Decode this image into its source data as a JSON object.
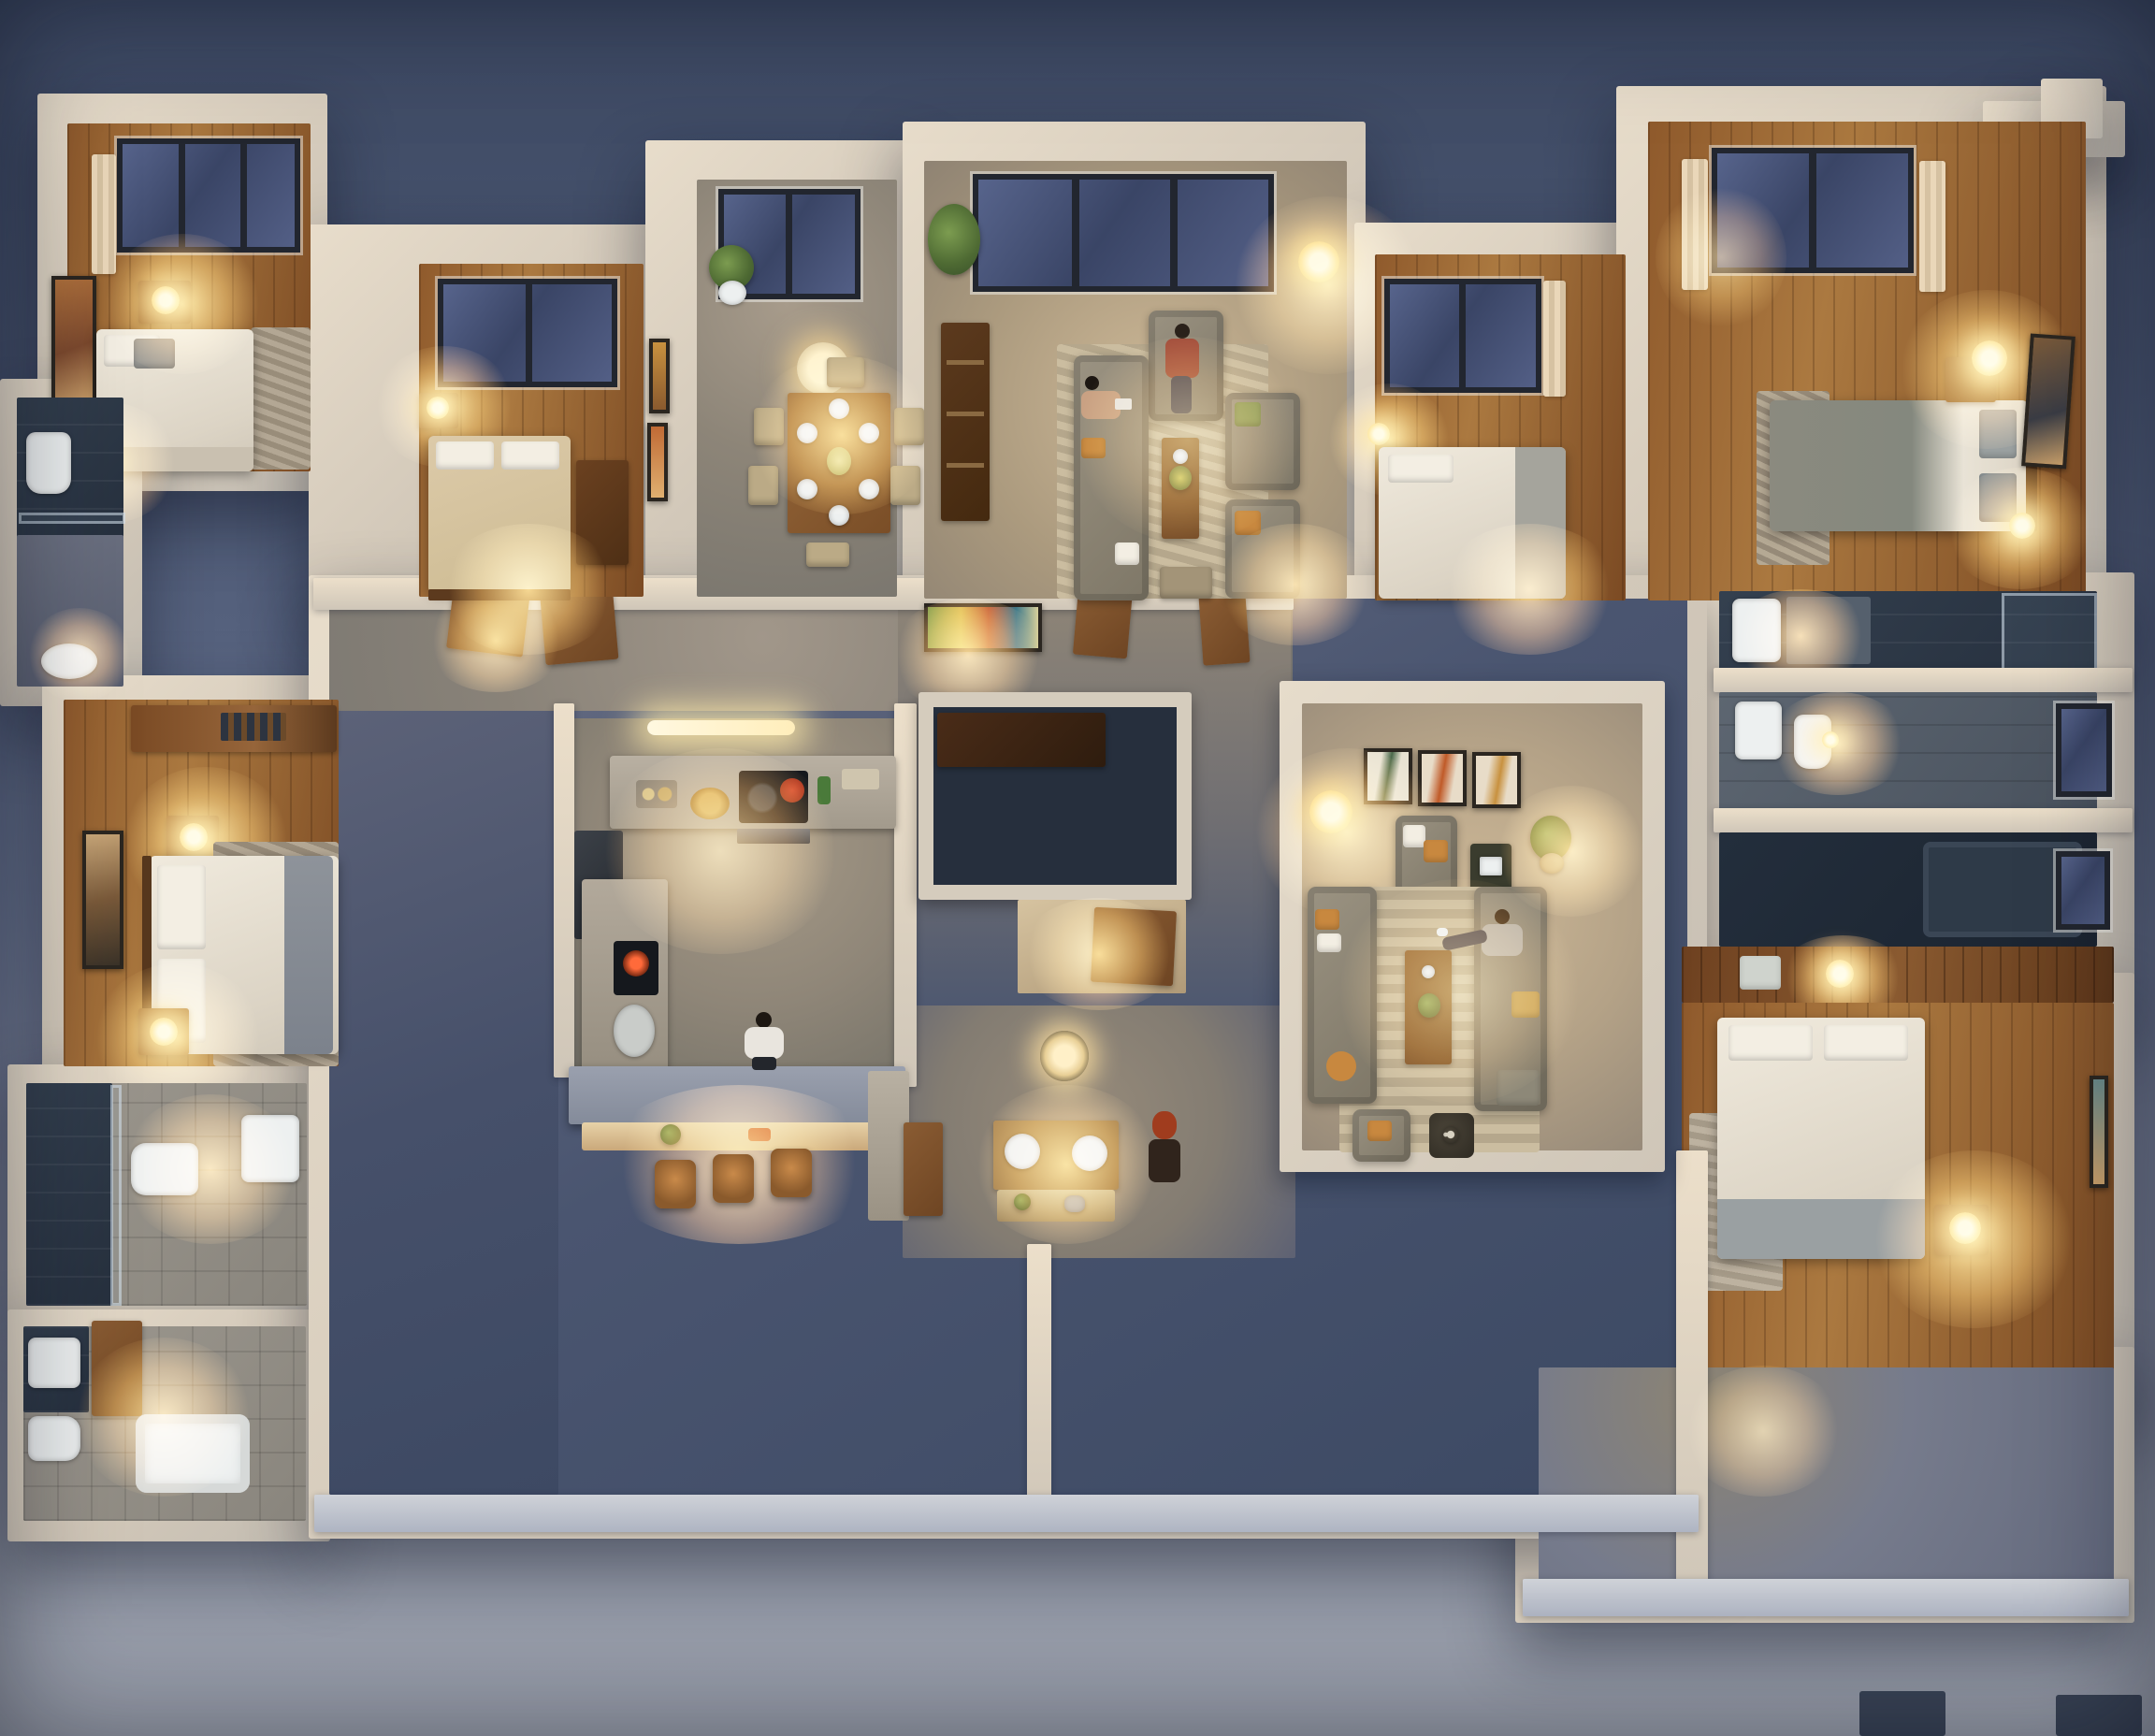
{
  "scene": {
    "type": "architectural-3d-render",
    "view": "top-down dollhouse cutaway floor plan",
    "time_of_day": "dusk",
    "mood": "warm interior lamp light against blue evening exterior"
  },
  "palette": {
    "sky_top": "#3d4963",
    "sky_mid": "#55617d",
    "sky_low": "#7e869d",
    "ground": "#9298a6",
    "ground_low": "#9ea3af",
    "wall_lit": "#d9cfc1",
    "wall_warm": "#ecd9bc",
    "wall_shadow": "#aeb4c2",
    "wood_a": "#8f5a2c",
    "wood_b": "#ab7940",
    "wood_dark": "#56371d",
    "concrete_warm": "#998f81",
    "concrete_cool": "#767b8c",
    "concrete_dark": "#3f4b66",
    "glass": "#3a4566",
    "frame_dark": "#22262f",
    "glow_warm": "#ffd88c",
    "lamp_core": "#fff6d8",
    "sofa_fabric": "#8d8575",
    "cushion_orange": "#c8883f",
    "bed_white": "#eae4d8",
    "bed_gray": "#97999a",
    "duvet_beige": "#d8c8a9",
    "duvet_graygreen": "#8b8a7f",
    "rug_beige": "#c6b89d",
    "rug_gray": "#9d968a",
    "table_wood": "#8a5c33",
    "chair_beige": "#b7a683",
    "plant_green": "#5d7a3d",
    "tile_warm": "#94908a",
    "tile_dark": "#2c3645",
    "fixture_white": "#eceff0",
    "curtain_cream": "#e2d7c2",
    "skin": "#c9a183",
    "hair_dark": "#2a211a",
    "hair_red": "#a03c1e",
    "shirt_white": "#e9e5de",
    "shirt_pattern": "#a04a3a",
    "denim": "#3c4252"
  },
  "rooms": [
    {
      "name": "bedroom-top-left",
      "floor": "wood",
      "furniture": [
        "double bed",
        "nightstand with lit lamp",
        "foot-of-bed lamp",
        "window with curtains",
        "wall art",
        "textured rug"
      ]
    },
    {
      "name": "bedroom-top-left-2",
      "floor": "wood",
      "furniture": [
        "double bed with beige duvet",
        "nightstand with lamp",
        "window",
        "wardrobe"
      ]
    },
    {
      "name": "dining-room",
      "floor": "concrete",
      "furniture": [
        "wood dining table set for six",
        "six beige chairs",
        "drum pendant lamp",
        "potted plant",
        "picture window",
        "two wall artworks"
      ]
    },
    {
      "name": "living-room-north",
      "floor": "carpet",
      "furniture": [
        "long sofa",
        "accent armchair",
        "two armchairs",
        "coffee table with flowers",
        "bookshelf",
        "tripod floor lamp",
        "potted palm",
        "wide window",
        "stool"
      ]
    },
    {
      "name": "bedroom-north-right",
      "floor": "wood",
      "furniture": [
        "white double bed",
        "small lit lamp",
        "window with curtain"
      ]
    },
    {
      "name": "bedroom-top-right",
      "floor": "wood",
      "furniture": [
        "double bed with gray-green duvet",
        "nightstand with glowing sphere lamp",
        "second lamp",
        "wide window with curtains",
        "wall art",
        "textured rug"
      ]
    },
    {
      "name": "bathroom-left-top",
      "floor": "dark tile",
      "furniture": [
        "walk-in shower",
        "toilet",
        "oval sink"
      ]
    },
    {
      "name": "bedroom-left-middle",
      "floor": "wood",
      "furniture": [
        "double bed with gray throw",
        "two nightstands with lit lamps",
        "wardrobe shelf",
        "large wall art",
        "textured rug"
      ]
    },
    {
      "name": "bathroom-left-middle",
      "floor": "tile",
      "furniture": [
        "glass shower",
        "toilet",
        "vanity sink"
      ]
    },
    {
      "name": "bathroom-left-bottom",
      "floor": "tile",
      "furniture": [
        "bathtub",
        "vanity sink",
        "toilet",
        "dark shower",
        "wood bath mat"
      ]
    },
    {
      "name": "kitchen",
      "floor": "concrete",
      "furniture": [
        "L-shaped counter",
        "cooktop with red pot",
        "oven",
        "island cooktop",
        "steel sink",
        "breakfast bar with lit ledge",
        "three bar stools",
        "ceiling tube light"
      ]
    },
    {
      "name": "hallway",
      "floor": "concrete",
      "furniture": [
        "open wood doors",
        "colorful wall painting"
      ]
    },
    {
      "name": "closet-room",
      "floor": "dark",
      "furniture": [
        "wood cabinet"
      ]
    },
    {
      "name": "vanity-bathroom-center",
      "floor": "concrete",
      "furniture": [
        "double round-basin wood vanity",
        "toiletry shelf",
        "ring ceiling light",
        "side cabinet"
      ]
    },
    {
      "name": "living-room-south",
      "floor": "carpet",
      "furniture": [
        "two facing sofas",
        "accent armchair",
        "dark pouf",
        "coffee table with plant",
        "triptych wall art",
        "tripod floor lamp",
        "potted plant",
        "striped rug",
        "side table"
      ]
    },
    {
      "name": "bathroom-right-1",
      "floor": "dark tile",
      "furniture": [
        "lit vanity basin",
        "glass shower"
      ]
    },
    {
      "name": "bathroom-right-2",
      "floor": "tile",
      "furniture": [
        "sink",
        "toilet",
        "window",
        "ceiling bulb"
      ]
    },
    {
      "name": "bathroom-right-3",
      "floor": "dark tile",
      "furniture": [
        "bathtub",
        "window"
      ]
    },
    {
      "name": "closet-right",
      "floor": "wood",
      "furniture": [
        "folded linens",
        "lit lamp"
      ]
    },
    {
      "name": "bedroom-right-bottom",
      "floor": "wood",
      "furniture": [
        "double bed",
        "nightstand with lit lamp",
        "rug",
        "wall art"
      ]
    },
    {
      "name": "terrace-south",
      "floor": "dark concrete",
      "furniture": []
    },
    {
      "name": "terrace-right",
      "floor": "concrete",
      "furniture": [
        "stacked window frames on parapet"
      ]
    }
  ],
  "people": [
    {
      "location": "kitchen",
      "description": "man standing at breakfast bar"
    },
    {
      "location": "living-room-north",
      "description": "man seated on sofa"
    },
    {
      "location": "living-room-north",
      "description": "woman seated in armchair"
    },
    {
      "location": "living-room-south",
      "description": "woman seated on sofa, legs crossed"
    },
    {
      "location": "vanity-bathroom-center",
      "description": "red-haired person standing at vanity"
    }
  ],
  "lights": {
    "style": "warm tungsten pools",
    "count_visible_lamps": 18
  }
}
